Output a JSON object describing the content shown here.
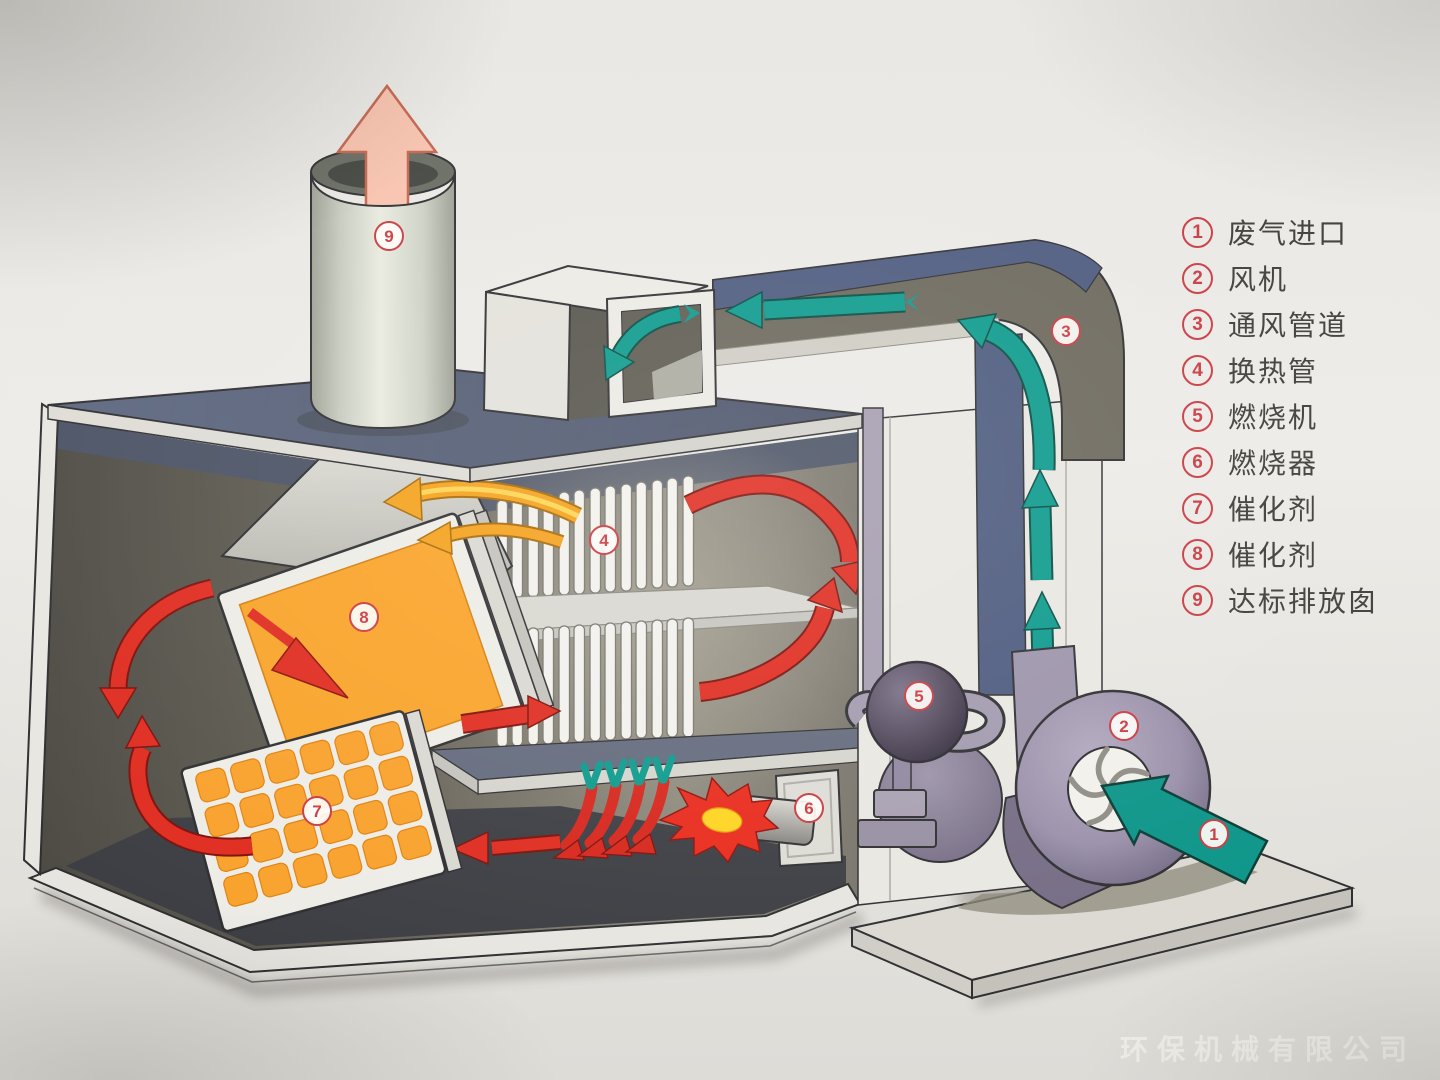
{
  "legend": {
    "items": [
      {
        "num": "1",
        "label": "废气进口"
      },
      {
        "num": "2",
        "label": "风机"
      },
      {
        "num": "3",
        "label": "通风管道"
      },
      {
        "num": "4",
        "label": "换热管"
      },
      {
        "num": "5",
        "label": "燃烧机"
      },
      {
        "num": "6",
        "label": "燃烧器"
      },
      {
        "num": "7",
        "label": "催化剂"
      },
      {
        "num": "8",
        "label": "催化剂"
      },
      {
        "num": "9",
        "label": "达标排放囱"
      }
    ]
  },
  "watermark": {
    "text": "环保机械有限公司"
  },
  "colors": {
    "badge_red": "#cb3a40",
    "flow_teal": "#0b9a8c",
    "flow_red": "#e02b1f",
    "flow_orange": "#f4a11c",
    "catalyst_orange": "#f9a328",
    "duct_blue": "#4d5a7e",
    "duct_olive": "#6b675c",
    "fan_purple": "#9c93aa",
    "exhaust_pink": "#f8c3ae",
    "paper": "#e9e7e3"
  }
}
